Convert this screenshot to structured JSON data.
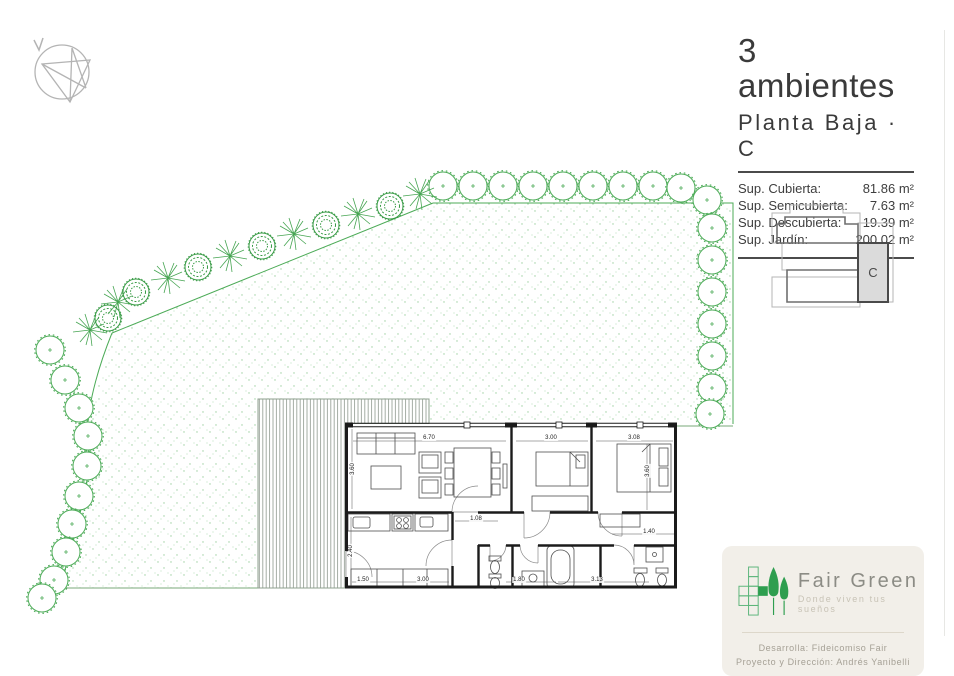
{
  "title_block": {
    "title": "3 ambientes",
    "subtitle": "Planta Baja · C",
    "areas": [
      {
        "label": "Sup. Cubierta:",
        "value": "81.86 m²"
      },
      {
        "label": "Sup. Semicubierta:",
        "value": "7.63 m²"
      },
      {
        "label": "Sup. Descubierta:",
        "value": "19.39 m²"
      },
      {
        "label": "Sup. Jardín:",
        "value": "200.02 m²"
      }
    ]
  },
  "key_plan": {
    "unit_label": "C"
  },
  "branding": {
    "name": "Fair Green",
    "tagline": "Donde viven tus sueños",
    "credit_line1": "Desarrolla: Fideicomiso Fair",
    "credit_line2": "Proyecto y Dirección: Andrés Yanibelli"
  },
  "floor_plan": {
    "dimensions": [
      {
        "value": "6.70",
        "x": 429,
        "y": 438
      },
      {
        "value": "3.00",
        "x": 551,
        "y": 438
      },
      {
        "value": "3.08",
        "x": 634,
        "y": 438
      },
      {
        "value": "3.60",
        "x": 353,
        "y": 469,
        "rot": 1
      },
      {
        "value": "3.60",
        "x": 648,
        "y": 471,
        "rot": 1
      },
      {
        "value": "1.08",
        "x": 476,
        "y": 519
      },
      {
        "value": "2.40",
        "x": 351,
        "y": 551,
        "rot": 1
      },
      {
        "value": "1.50",
        "x": 363,
        "y": 580
      },
      {
        "value": "3.00",
        "x": 423,
        "y": 580
      },
      {
        "value": "1.80",
        "x": 519,
        "y": 580
      },
      {
        "value": "3.13",
        "x": 597,
        "y": 580
      },
      {
        "value": "1.40",
        "x": 649,
        "y": 532
      }
    ]
  },
  "colors": {
    "tree_green": "#4cab57",
    "stipple_green": "#9ccf9f",
    "wall_black": "#1b1b1b",
    "card_beige": "#f2efe9",
    "logo_green": "#2e9e4f"
  }
}
